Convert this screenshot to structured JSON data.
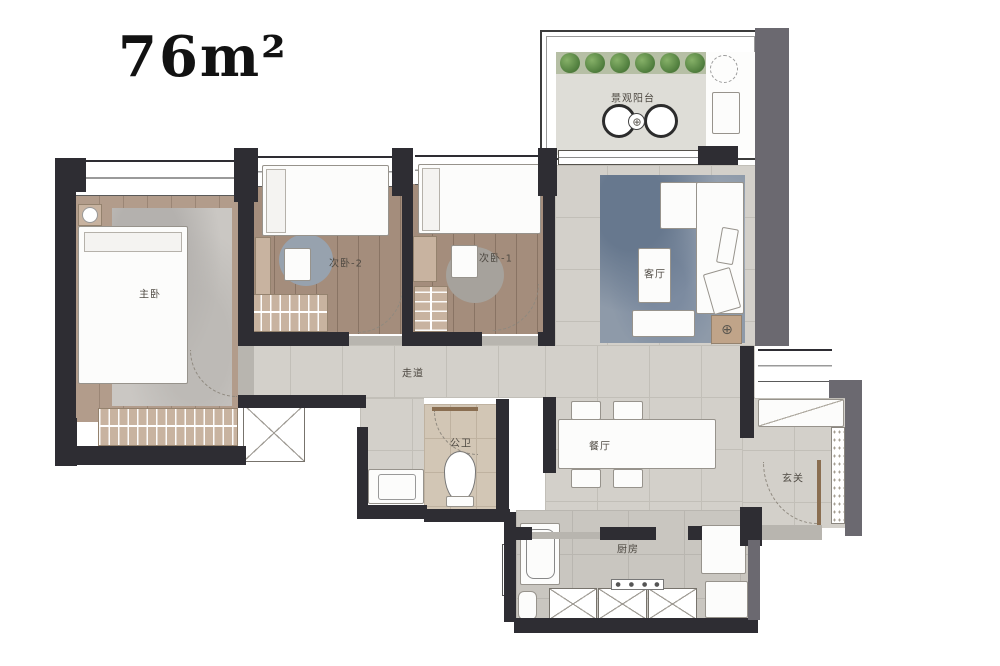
{
  "title": "76m²",
  "rooms": {
    "balcony": {
      "label": "景观阳台"
    },
    "master_bedroom": {
      "label": "主卧"
    },
    "bedroom_2": {
      "label": "次卧-2"
    },
    "bedroom_1": {
      "label": "次卧-1"
    },
    "living_room": {
      "label": "客厅"
    },
    "corridor": {
      "label": "走道"
    },
    "bathroom": {
      "label": "公卫"
    },
    "dining_room": {
      "label": "餐厅"
    },
    "foyer": {
      "label": "玄关"
    },
    "kitchen": {
      "label": "厨房"
    }
  },
  "icons": {
    "target": "⊕"
  },
  "colors": {
    "wall_dark": "#2e2d33",
    "wall_gray": "#6b6970",
    "wood_floor": "#a48d7c",
    "master_wood": "#b29c8b",
    "tile_floor": "#d3d0ca",
    "kitchen_tile": "#c9c6c0",
    "balcony_floor": "#deddd7",
    "bath_floor": "#d2c6b5",
    "living_rug": "#8e9aa9",
    "cabinet_beige": "#c8b3a0",
    "plant_green": "#4b793a",
    "door_wood": "#8a6e51",
    "furniture_white": "#fcfcfb"
  }
}
